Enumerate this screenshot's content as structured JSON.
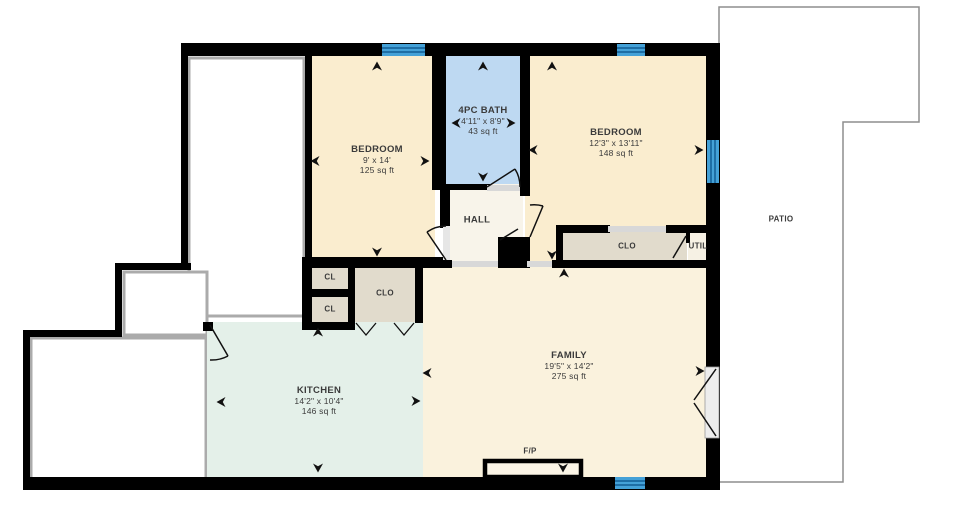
{
  "floor_plan": {
    "rooms": [
      {
        "name": "BEDROOM",
        "dims": "9' x 14'",
        "area": "125 sq ft"
      },
      {
        "name": "4PC BATH",
        "dims": "4'11\" x 8'9\"",
        "area": "43 sq ft"
      },
      {
        "name": "BEDROOM",
        "dims": "12'3\" x 13'11\"",
        "area": "148 sq ft"
      },
      {
        "name": "HALL"
      },
      {
        "name": "FAMILY",
        "dims": "19'5\" x 14'2\"",
        "area": "275 sq ft"
      },
      {
        "name": "KITCHEN",
        "dims": "14'2\" x 10'4\"",
        "area": "146 sq ft"
      },
      {
        "name": "PATIO"
      }
    ],
    "labels": {
      "closet_small_1": "CL",
      "closet_small_2": "CL",
      "closet_left": "CLO",
      "closet_bedroom2": "CLO",
      "utility": "UTIL",
      "fireplace": "F/P"
    },
    "colors": {
      "wall": "#000000",
      "bedroom_fill": "#FAEDCF",
      "family_fill": "#FAF2DD",
      "bath_fill": "#BED9F2",
      "kitchen_fill": "#E4F0E9",
      "hall_fill": "#F8F4EA",
      "closet_fill": "#E1DBCC",
      "utility_fill": "#F6F1E4",
      "window_blue": "#44A1D7",
      "window_stripe": "#1E6EA5",
      "outside_border": "#ABABAB",
      "patio_border": "#8E8E8E",
      "text": "#3B3B3B"
    }
  }
}
